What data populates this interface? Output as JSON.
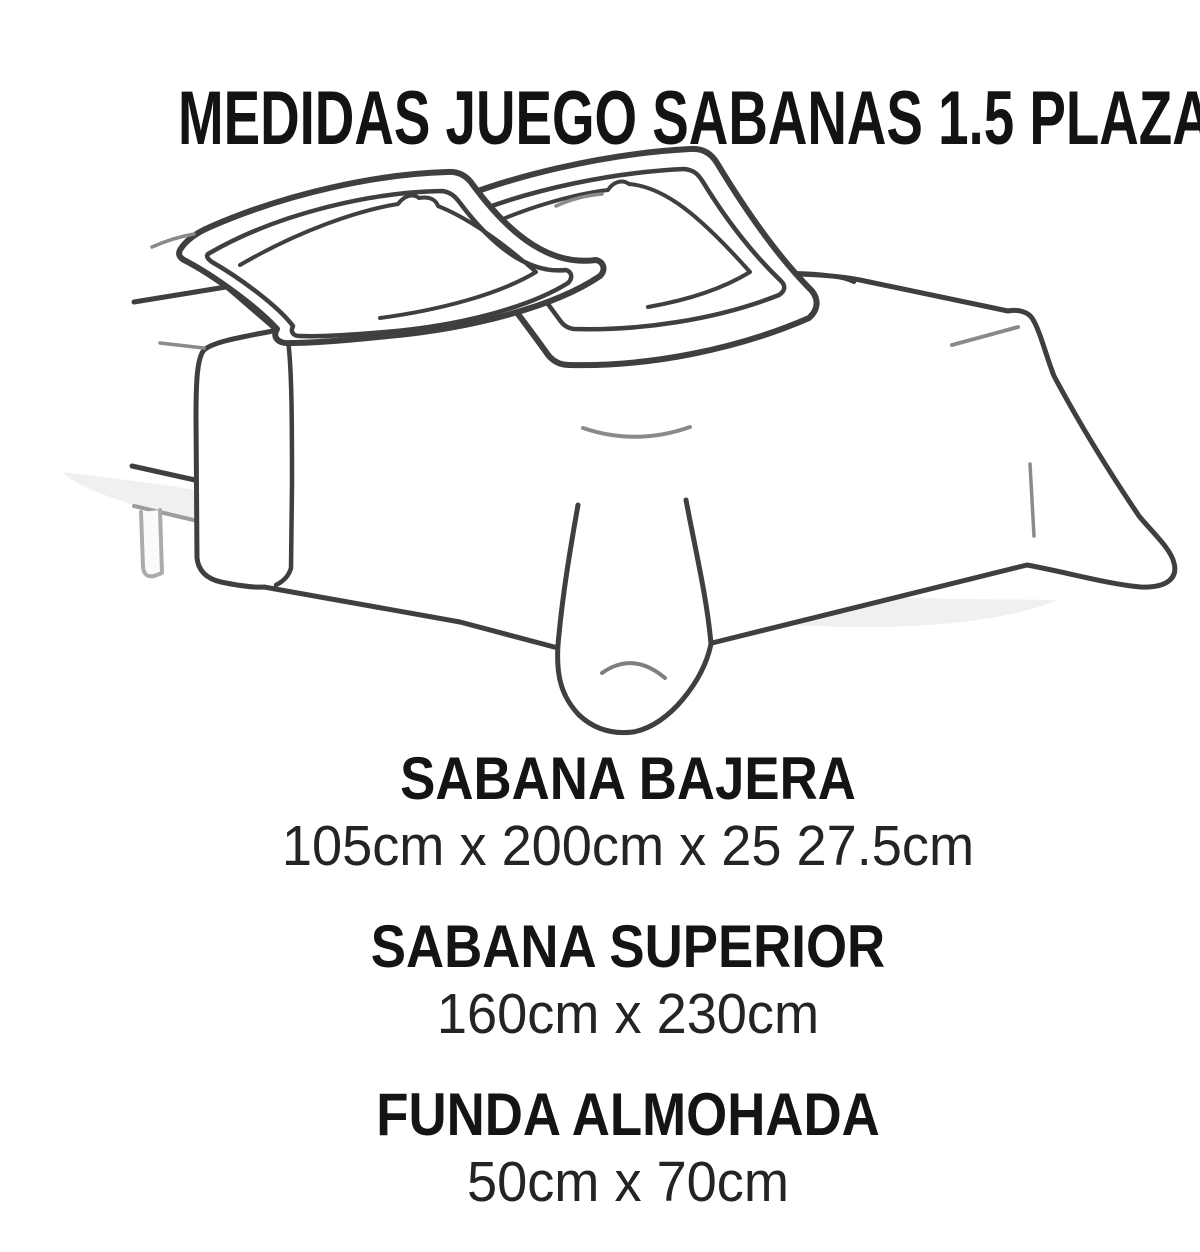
{
  "title": "MEDIDAS JUEGO SABANAS 1.5 PLAZAS",
  "illustration": {
    "alt": "bed-line-drawing",
    "parts": [
      "pillow-left",
      "pillow-right",
      "top-sheet",
      "bed-frame",
      "shadow"
    ]
  },
  "sections": [
    {
      "label": "SABANA BAJERA",
      "measurement": "105cm x 200cm x 25 27.5cm"
    },
    {
      "label": "SABANA SUPERIOR",
      "measurement": "160cm x 230cm"
    },
    {
      "label": "FUNDA ALMOHADA",
      "measurement": "50cm x 70cm"
    }
  ],
  "colors": {
    "background": "#ffffff",
    "text": "#141414",
    "line": "#3f3f3f",
    "crease": "#8a8a8a",
    "frame_light": "#a8a8a8",
    "shadow": "#ededed"
  }
}
